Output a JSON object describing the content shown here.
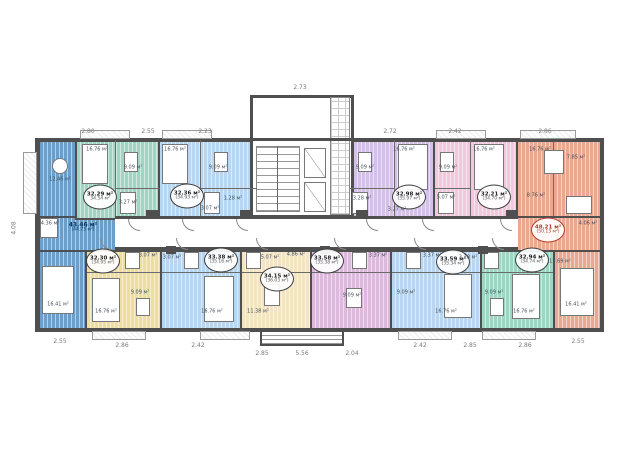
{
  "plan": {
    "units": [
      {
        "id": "left-end-apartment",
        "color": "blue",
        "area": "43.46 м²",
        "area_total": "(44.73 м²)",
        "badge": "text"
      },
      {
        "id": "top-apartment-1",
        "color": "green",
        "area": "32.29 м²",
        "area_total": "34.54 м²",
        "badge": "circle"
      },
      {
        "id": "top-apartment-2",
        "color": "light-blue",
        "area": "32.36 м²",
        "area_total": "(34.93 м²)",
        "badge": "circle"
      },
      {
        "id": "top-apartment-3",
        "color": "purple",
        "area": "32.98 м²",
        "area_total": "(35.97 м²)",
        "badge": "circle"
      },
      {
        "id": "top-apartment-4",
        "color": "pink",
        "area": "32.21 м²",
        "area_total": "(34.70 м²)",
        "badge": "circle"
      },
      {
        "id": "right-end-apartment",
        "color": "orange",
        "area": "48.21 м²",
        "area_total": "(50.13 м²)",
        "badge": "circle-red"
      },
      {
        "id": "bottom-apartment-1",
        "color": "yellow",
        "area": "32.30 м²",
        "area_total": "(34.95 м²)",
        "badge": "circle"
      },
      {
        "id": "bottom-apartment-2",
        "color": "light-blue",
        "area": "33.38 м²",
        "area_total": "(35.16 м²)",
        "badge": "circle"
      },
      {
        "id": "bottom-apartment-3",
        "color": "cream",
        "area": "34.15 м²",
        "area_total": "(36.03 м²)",
        "badge": "circle"
      },
      {
        "id": "bottom-apartment-4",
        "color": "purple-pink",
        "area": "33.58 м²",
        "area_total": "(35.38 м²)",
        "badge": "circle"
      },
      {
        "id": "bottom-apartment-5",
        "color": "light-blue",
        "area": "33.59 м²",
        "area_total": "(35.34 м²)",
        "badge": "circle"
      },
      {
        "id": "bottom-apartment-6",
        "color": "green",
        "area": "32.94 м²",
        "area_total": "(34.74 м²)",
        "badge": "circle"
      }
    ],
    "rooms": [
      {
        "text": "12.46 м²"
      },
      {
        "text": "4.36 м²"
      },
      {
        "text": "16.41 м²"
      },
      {
        "text": "16.76 м²"
      },
      {
        "text": "9.09 м²"
      },
      {
        "text": "3.27 м²"
      },
      {
        "text": "16.76 м²"
      },
      {
        "text": "9.09 м²"
      },
      {
        "text": "1.28 м²"
      },
      {
        "text": "3.07 м²"
      },
      {
        "text": "16.76 м²"
      },
      {
        "text": "9.09 м²"
      },
      {
        "text": "3.28 м²"
      },
      {
        "text": "3.27 м²"
      },
      {
        "text": "16.76 м²"
      },
      {
        "text": "9.09 м²"
      },
      {
        "text": "5.07 м²"
      },
      {
        "text": "16.76 м²"
      },
      {
        "text": "7.85 м²"
      },
      {
        "text": "8.76 м²"
      },
      {
        "text": "4.06 м²"
      },
      {
        "text": "12.69 м²"
      },
      {
        "text": "16.41 м²"
      },
      {
        "text": "9.09 м²"
      },
      {
        "text": "16.76 м²"
      },
      {
        "text": "3.07 м²"
      },
      {
        "text": "16.76 м²"
      },
      {
        "text": "3.07 м²"
      },
      {
        "text": "11.38 м²"
      },
      {
        "text": "5.07 м²"
      },
      {
        "text": "4.86 м²"
      },
      {
        "text": "9.09 м²"
      },
      {
        "text": "3.37 м²"
      },
      {
        "text": "9.09 м²"
      },
      {
        "text": "16.76 м²"
      },
      {
        "text": "3.37 м²"
      },
      {
        "text": "9.09 м²"
      },
      {
        "text": "16.76 м²"
      },
      {
        "text": "3.28 м²"
      }
    ],
    "dims": {
      "top": [
        "2.80",
        "2.55",
        "2.23",
        "2.73",
        "2.72",
        "2.42",
        "2.86"
      ],
      "bottom": [
        "2.55",
        "2.86",
        "2.42",
        "2.85",
        "5.56",
        "2.04",
        "2.42",
        "2.85",
        "2.86",
        "2.55"
      ],
      "left": "4.08"
    },
    "colors": {
      "wall": "#4f4f4f",
      "blue": "#6d9ec7",
      "green": "#9fd6c3",
      "light_blue": "#b9d6f0",
      "purple": "#d5c0e8",
      "pink": "#f3c8dc",
      "orange": "#e9a88f",
      "yellow": "#ecdf9e",
      "cream": "#f4e4c4",
      "purple_pink": "#dcb9dd",
      "red_accent": "#b03a2e"
    }
  }
}
